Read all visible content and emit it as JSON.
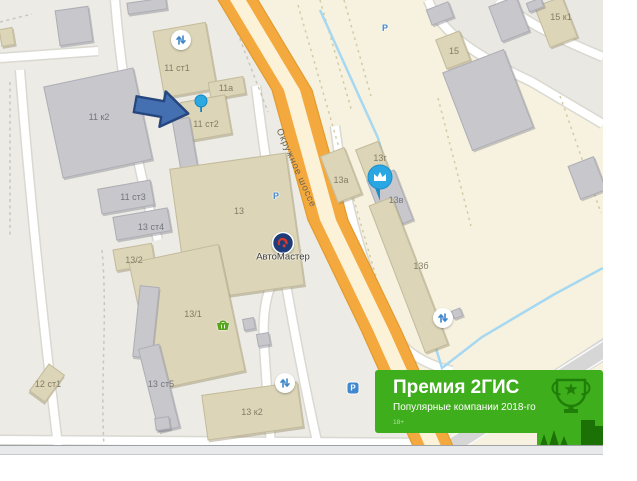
{
  "map": {
    "road_label": "Окружное шоссе",
    "building_labels": [
      "11 к2",
      "11 ст1",
      "11а",
      "11 ст2",
      "11 ст3",
      "13 ст4",
      "13/2",
      "13",
      "13/1",
      "12 ст1",
      "13 ст5",
      "13 к2",
      "13а",
      "13г",
      "13в",
      "13б",
      "15",
      "15 к1"
    ],
    "firm_label": "АвтоМастер",
    "parking_letter": "P",
    "icons": {
      "gate_icon": "up-down-arrows-in-white-circle",
      "parking_icon": "blue letter P",
      "paid_parking_badge": "white P on blue rounded square",
      "basket_icon": "green shopping basket",
      "crown_marker": "white crown in blue balloon",
      "location_pin": "small blue pin",
      "pointer_arrow": "large blue right arrow annotation",
      "firm_logo": "red emblem in navy circle"
    }
  },
  "banner": {
    "title": "Премия 2ГИС",
    "subtitle": "Популярные компании 2018-го",
    "age_rating": "18+",
    "bg_color": "#3fae1c"
  },
  "colors": {
    "map_bg": "#ecebe5",
    "field_bg": "#f6f2df",
    "road_orange": "#f4a93f",
    "road_center": "#fcf2d8",
    "building_beige": "#dcd5b7",
    "building_gray": "#c7c7cc",
    "marker_blue": "#2aa7e2",
    "arrow_blue": "#4470b2",
    "banner_green": "#3fae1c",
    "logo_navy": "#1e3c78",
    "logo_red": "#d5372b",
    "stream_blue": "#a6d8f2"
  }
}
